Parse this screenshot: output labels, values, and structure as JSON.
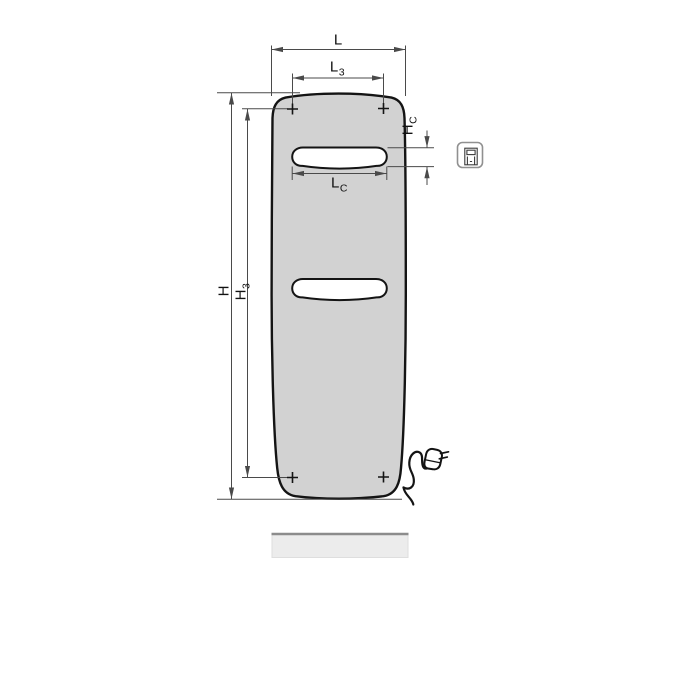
{
  "figure": {
    "type": "technical dimension drawing",
    "subject": "flat panel radiator, front view, with electric cable and plug",
    "background": "#ffffff"
  },
  "colors": {
    "panel_fill": "#d2d2d2",
    "panel_outline": "#141414",
    "slot_fill": "#ffffff",
    "dimension_lines": "#4a4a4a",
    "label_text": "#111111",
    "base_shadow_fill": "#ececec",
    "base_shadow_top": "#8c8c8c",
    "icon_border": "#909090"
  },
  "dimension_labels": {
    "overall_width": {
      "main": "L",
      "sub": ""
    },
    "mounting_width": {
      "main": "L",
      "sub": "3"
    },
    "slot_length": {
      "main": "L",
      "sub": "C"
    },
    "overall_height": {
      "main": "H",
      "sub": ""
    },
    "mounting_height": {
      "main": "H",
      "sub": "3"
    },
    "slot_height": {
      "main": "H",
      "sub": "C"
    }
  },
  "markers": {
    "corner_mark_symbol": "+",
    "corner_mark_count": 4
  },
  "icon": {
    "name": "electric-connection-icon"
  }
}
